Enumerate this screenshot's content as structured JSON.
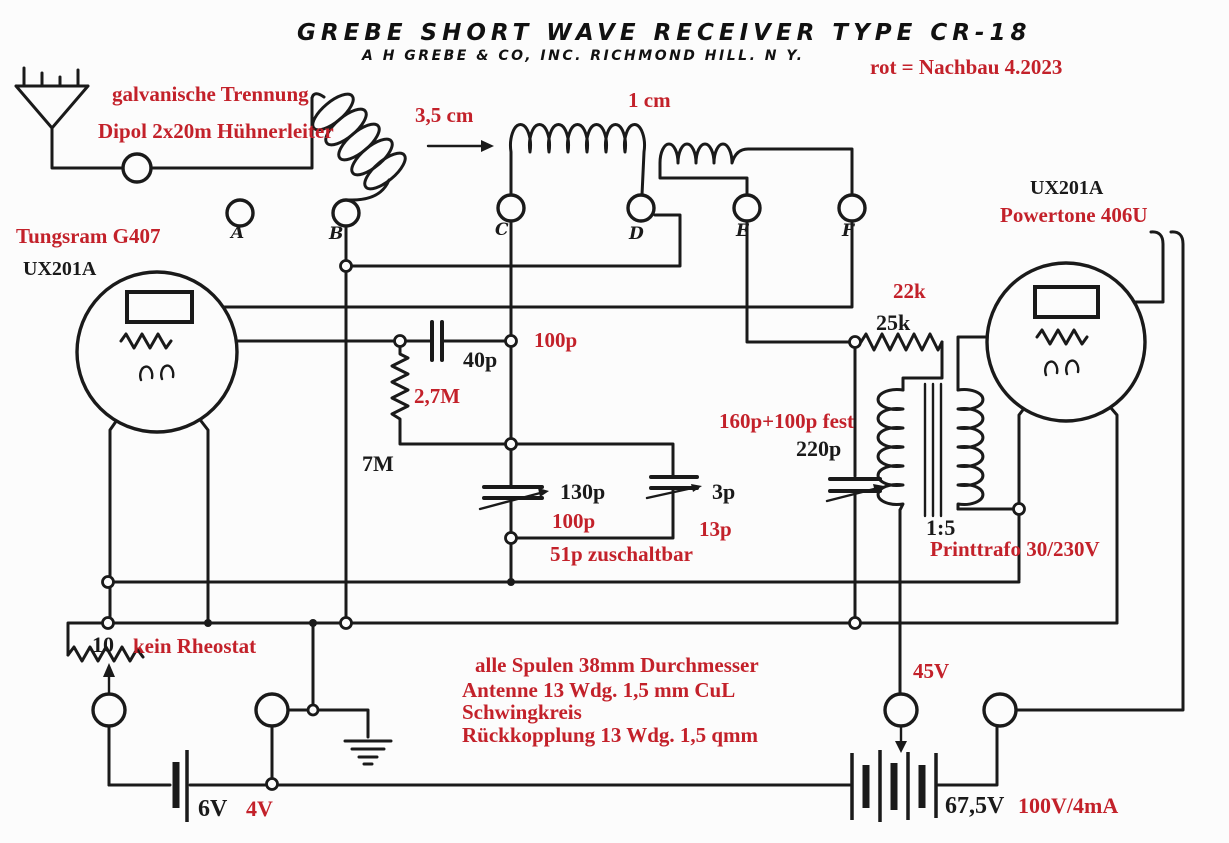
{
  "colors": {
    "annotation_red": "#c3212a",
    "ink_black": "#1a1a1a",
    "paper": "#fcfcfc"
  },
  "title": {
    "line1": "GREBE  SHORT  WAVE  RECEIVER  TYPE CR-18",
    "line2": "A H GREBE & CO, INC.    RICHMOND HILL. N Y."
  },
  "legend": {
    "note": "rot = Nachbau 4.2023"
  },
  "antenna": {
    "isolation": "galvanische Trennung",
    "type": "Dipol 2x20m Hühnerleiter"
  },
  "coils": {
    "left_len": "3,5 cm",
    "gap": "1 cm"
  },
  "terminals": [
    "A",
    "B",
    "C",
    "D",
    "E",
    "F"
  ],
  "tubes": {
    "left_make": "Tungsram G407",
    "left_type": "UX201A",
    "right_type": "UX201A",
    "right_make": "Powertone 406U"
  },
  "capacitors": {
    "grid": "40p",
    "grid_new": "100p",
    "tuning": "130p",
    "tuning_new": "100p",
    "fine": "3p",
    "fine_new": "13p",
    "switch_note": "51p zuschaltbar",
    "coupling_new": "160p+100p fest",
    "coupling": "220p"
  },
  "resistors": {
    "grid_leak": "7M",
    "grid_leak_new": "2,7M",
    "plate": "25k",
    "plate_new": "22k",
    "rheostat": "10",
    "rheostat_note": "kein Rheostat"
  },
  "transformer": {
    "ratio": "1:5",
    "note": "Printtrafo 30/230V"
  },
  "coil_notes": [
    "alle Spulen 38mm Durchmesser",
    "Antenne 13 Wdg. 1,5 mm CuL",
    "Schwingkreis",
    "Rückkopplung 13 Wdg. 1,5 qmm"
  ],
  "power": {
    "plate_tap": "45V",
    "filament": "6V",
    "filament_new": "4V",
    "plate_batt": "67,5V",
    "plate_batt_new": "100V/4mA"
  }
}
